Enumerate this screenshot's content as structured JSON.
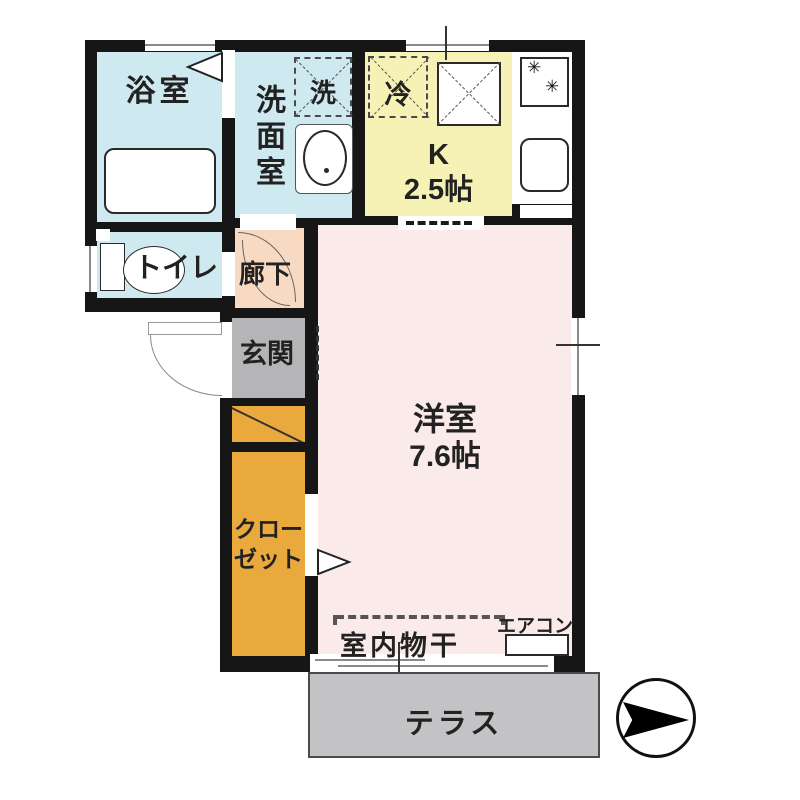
{
  "plan": {
    "rooms": {
      "bath": {
        "label": "浴室"
      },
      "washroom": {
        "label": "洗面室"
      },
      "washer": {
        "label": "洗"
      },
      "fridge": {
        "label": "冷"
      },
      "kitchen": {
        "label_line1": "K",
        "label_line2": "2.5帖"
      },
      "toilet": {
        "label": "トイレ"
      },
      "hallway": {
        "label": "廊下"
      },
      "genkan": {
        "label": "玄関"
      },
      "closet": {
        "label_line1": "クロー",
        "label_line2": "ゼット"
      },
      "living": {
        "label_line1": "洋室",
        "label_line2": "7.6帖"
      },
      "monohoshi": {
        "label": "室内物干"
      },
      "aircon": {
        "label": "エアコン"
      },
      "terrace": {
        "label": "テラス"
      }
    },
    "colors": {
      "wall": "#161616",
      "bath": "#cfe9f0",
      "washroom": "#cfe9f0",
      "toilet": "#cfe9f0",
      "kitchen": "#f6f2b6",
      "hallway": "#f7dac1",
      "genkan": "#b5b5b7",
      "shoe_closet": "#e9a93d",
      "living": "#fbeaea",
      "terrace": "#c3c3c5"
    },
    "icons": {
      "compass": "north-arrow-icon",
      "stove_burners": "✳"
    }
  }
}
